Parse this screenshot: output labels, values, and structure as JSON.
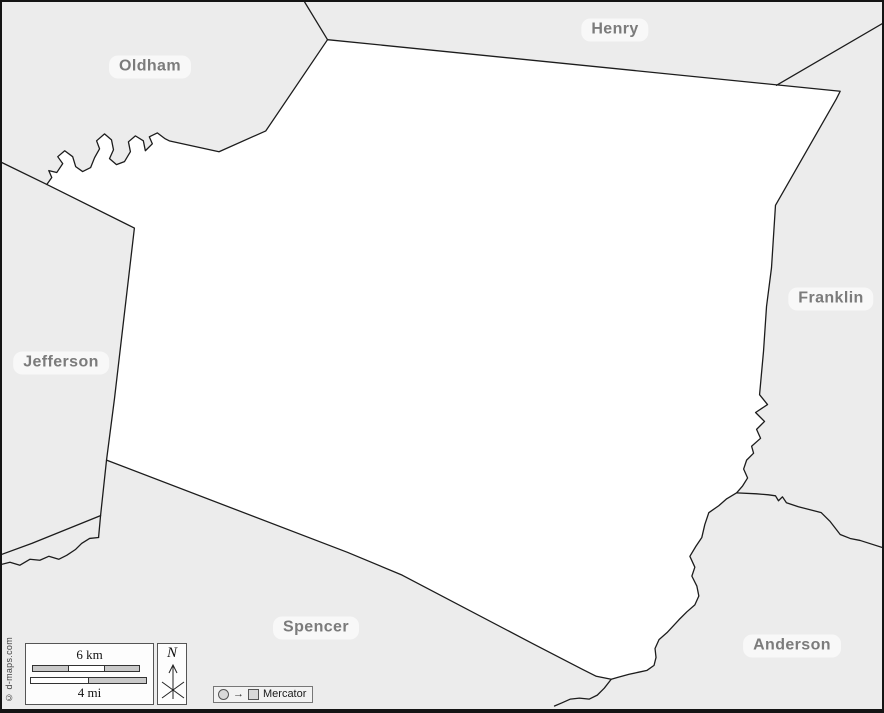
{
  "map": {
    "region_labels": {
      "oldham": "Oldham",
      "henry": "Henry",
      "franklin": "Franklin",
      "jefferson": "Jefferson",
      "spencer": "Spencer",
      "anderson": "Anderson"
    }
  },
  "legend": {
    "scale": {
      "km_label": "6 km",
      "mi_label": "4 mi"
    },
    "compass": {
      "north_label": "N"
    },
    "projection": {
      "symbol_arrow": "→",
      "label": "Mercator"
    }
  },
  "copyright": "© d-maps.com",
  "colors": {
    "background": "#ececec",
    "central_county_fill": "#ffffff",
    "boundary_line": "#1c1c1c",
    "label_text": "#7b7b7b",
    "label_pill": "rgba(255,255,255,0.62)"
  }
}
